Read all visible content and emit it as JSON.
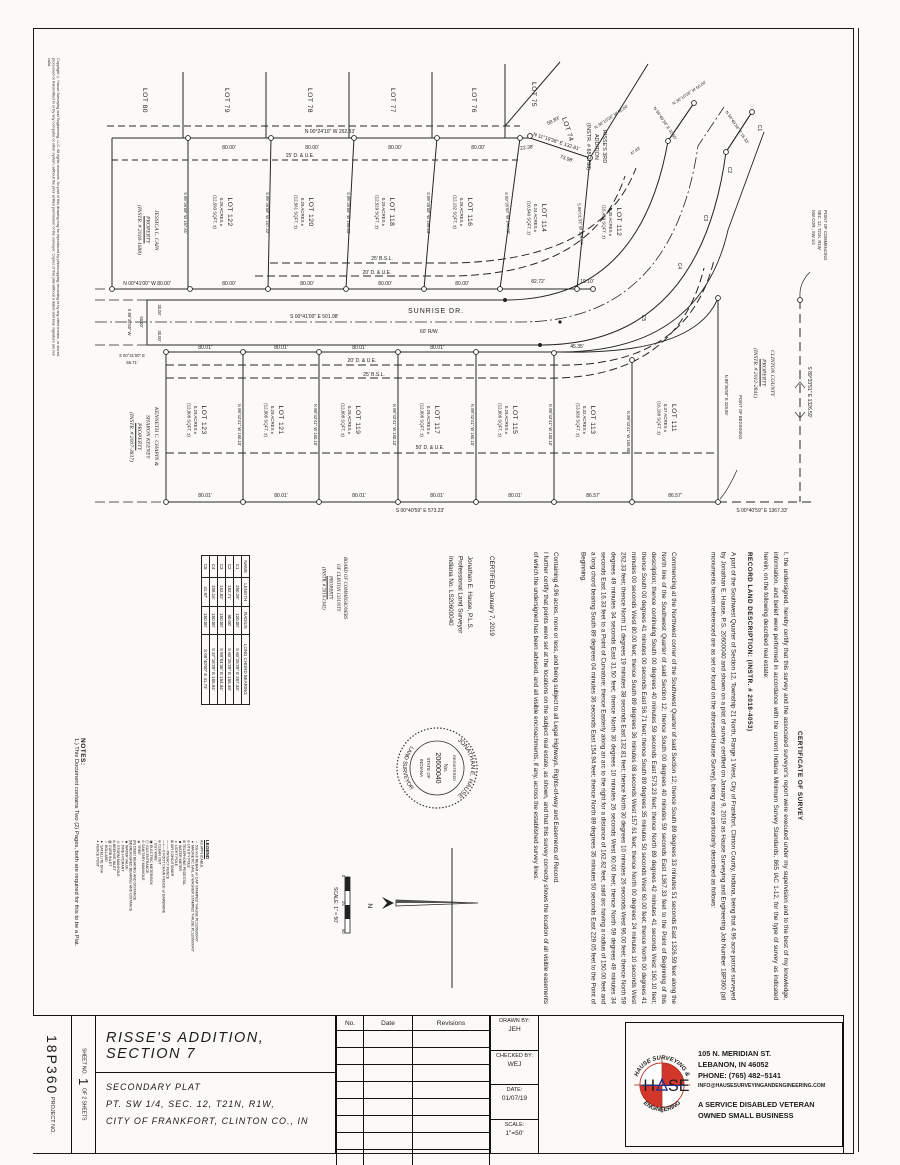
{
  "doc": {
    "type_note": "Secondary plat survey drawing"
  },
  "copyright": "Copyright © Hause Surveying and Engineering, LLC. All rights reserved. No part of this drawing may be reproduced by photocopying, recording or by any other means, or stored, processed or transmitted in or by any computer or other system, without the prior written permission of the surveyor. Copies of this plat without a dated and blue signature are not valid.",
  "plat": {
    "neighbors": [
      "LOT 80",
      "LOT 79",
      "LOT 78",
      "LOT 77",
      "LOT 76",
      "LOT 75"
    ],
    "lot74": {
      "name": "LOT 74",
      "lines": [
        "RISSE'S 3RD",
        "ADDITION",
        "(INSTR. # 68-2788)"
      ]
    },
    "upper_lots": [
      {
        "name": "LOT 122",
        "acres": "0.28 ACRES ±",
        "sqft": "(12,593 SQFT. ±)",
        "side": "S 89°36'08\" W  157.61'"
      },
      {
        "name": "LOT 120",
        "acres": "0.29 ACRES ±",
        "sqft": "(12,561 SQFT. ±)",
        "side": "S 89°36'08\" W  157.22'"
      },
      {
        "name": "LOT 118",
        "acres": "0.29 ACRES ±",
        "sqft": "(12,529 SQFT. ±)",
        "side": "S 89°36'08\" W  156.83'"
      },
      {
        "name": "LOT 116",
        "acres": "0.28 ACRES ±",
        "sqft": "(12,132 SQFT. ±)",
        "side": "S 89°36'08\" W  156.43'"
      },
      {
        "name": "LOT 114",
        "acres": "0.24 ACRES ±",
        "sqft": "(10,540 SQFT. ±)",
        "side": "S 89°35'50\" W  144.08'"
      },
      {
        "name": "LOT 112",
        "acres": "0.35 ACRES ±",
        "sqft": "(15,459 SQFT. ±)",
        "side": "S 89°01'33\" W  129.04'"
      }
    ],
    "lower_lots": [
      {
        "name": "LOT 123",
        "acres": "0.29 ACRES ±",
        "sqft": "(12,808 SQFT. ±)",
        "side": "N 89°42'41\" W  160.10'"
      },
      {
        "name": "LOT 121",
        "acres": "0.29 ACRES ±",
        "sqft": "(12,808 SQFT. ±)",
        "side": "N 89°42'41\" W  160.10'"
      },
      {
        "name": "LOT 119",
        "acres": "0.29 ACRES ±",
        "sqft": "(12,808 SQFT. ±)",
        "side": "N 89°42'41\" W  160.10'"
      },
      {
        "name": "LOT 117",
        "acres": "0.29 ACRES ±",
        "sqft": "(12,808 SQFT. ±)",
        "side": "N 89°42'41\" W  160.10'"
      },
      {
        "name": "LOT 115",
        "acres": "0.29 ACRES ±",
        "sqft": "(12,808 SQFT. ±)",
        "side": "N 89°42'41\" W  160.10'"
      },
      {
        "name": "LOT 113",
        "acres": "0.32 ACRES ±",
        "sqft": "(13,936 SQFT. ±)",
        "side": "N 89°42'41\" W  165.90'"
      },
      {
        "name": "LOT 111",
        "acres": "0.37 ACRES ±",
        "sqft": "(16,188 SQFT. ±)",
        "side": "N 89°35'50\" E  229.05'"
      }
    ],
    "street": {
      "name": "SUNRISE DR.",
      "rw": "60'  R/W",
      "bearing": "S 00°41'00\" E   501.98'"
    },
    "dims": {
      "top_bearing": "N 00°24'10\" W   262.33'",
      "seg80": "80.00'",
      "seg2238": "22.38'",
      "seg5883": "58.83'",
      "diag_bearing": "N 11°19'38\" E   132.81'",
      "seg7398": "73.98'",
      "seg8272": "82.72'",
      "seg1910": "19.10'",
      "west80": "N 00°41'00\" W   80.00'",
      "seg8001": "80.01'",
      "seg4535": "45.35'",
      "seg8657": "86.57'",
      "bottom_bearing": "S 00°40'59\" E   573.23'",
      "east_bearing": "S 00°40'59\" E   1367.33'",
      "north_line": "S 89°33'51\" E   1326.59'",
      "jog_30": "30.00'",
      "jog_60": "60.00'",
      "jog_brg": "S 89°35'50\" W",
      "jog_e": "S 00°41'00\" E",
      "jog_5671": "56.71'",
      "stub": [
        "N 30°10'26\" W  96.00'",
        "N 59°49'34\" E  31.50'",
        "N 30°10'26\" W  60.00'",
        "N 59°49'34\" E  16.33'",
        "47.83'"
      ]
    },
    "easements_upper": [
      "15' D. & U.E.",
      "25' B.S.L.",
      "20' D. & U.E."
    ],
    "easements_lower": [
      "20' D. & U.E.",
      "25' B.S.L.",
      "50' D. & U.E."
    ],
    "curve_labels": [
      "C1",
      "C2",
      "C3",
      "C4",
      "C5"
    ],
    "poc_label": [
      "NW COR., SW 1/4",
      "SEC. 12, T21N, R1W",
      "POINT OF COMMENCING"
    ],
    "pob_label": "POINT OF BEGINNING",
    "owners": {
      "jessica": [
        "JESSICA L. CAIN",
        "PROPERTY",
        "(INSTR. # 2018-1688)"
      ],
      "kenneth": [
        "KENNETH C. CHAPIN &",
        "SHARON KEENEY",
        "PROPERTY",
        "(INSTR. # 2007-3837)"
      ],
      "clinton": [
        "CLINTON COUNTY",
        "PROPERTY",
        "(INSTR. # 2012-2841)"
      ],
      "board": [
        "BOARD OF COMMISSIONERS",
        "OF CLINTON COUNTY",
        "PROPERTY",
        "(INSTR. # 2010-1342)"
      ]
    },
    "curve_table": {
      "headers": [
        "NAME",
        "LENGTH",
        "RADIUS",
        "LONG CHORD BEARING"
      ],
      "rows": [
        [
          "C1",
          "250.28'",
          "120.00'",
          "S 60°25'28\" E   207.33'"
        ],
        [
          "C2",
          "182.71'",
          "90.00'",
          "S 60°25'28\" E   155.49'"
        ],
        [
          "C3",
          "162.82'",
          "150.00'",
          "S 89°04'36\" E   154.94'"
        ],
        [
          "C4",
          "108.16'",
          "150.00'",
          "S 37°18'28\" E   105.84'"
        ],
        [
          "C5",
          "41.97'",
          "150.00'",
          "S 08°40'00\" E   41.73'"
        ]
      ]
    },
    "legend": {
      "title": "LEGEND",
      "subtitle": "AS APPLICABLE",
      "items": [
        {
          "sym": "○",
          "label": "5/8-inch REBAR w/ CAP STAMPED \"HAUSE PLS20600040\""
        },
        {
          "sym": "●",
          "label": "MAGNETIC NAIL w/ WASHER STAMPED \"HAUSE PLS20600040\""
        },
        {
          "sym": "⊘",
          "label": "UTILITY POLE"
        },
        {
          "sym": "⊞",
          "label": "TELEPHONE PEDESTAL"
        },
        {
          "sym": "◙",
          "label": "WATER METER"
        },
        {
          "sym": "✶",
          "label": "LIGHT POLE"
        },
        {
          "sym": "⊠",
          "label": "AIR CONDITIONER"
        },
        {
          "sym": "—··—",
          "label": "PRIVACY FENCE"
        },
        {
          "sym": "—+—",
          "label": "6 FOOT CHAIN FENCE w/ BARBWIRE"
        },
        {
          "sym": "⊕",
          "label": "CLEAN OUT"
        },
        {
          "sym": "↓",
          "label": "GUY WIRE"
        },
        {
          "sym": "▣",
          "label": "ELECTRIC METER/BOX"
        },
        {
          "sym": "◫",
          "label": "GAS ENTRANCE"
        },
        {
          "sym": "⊙",
          "label": "SANITARY MANHOLE"
        },
        {
          "sym": "❀",
          "label": "TREE"
        },
        {
          "sym": "(R)",
          "label": "DEED BEARING AND DISTANCE"
        },
        {
          "sym": "(M)",
          "label": "MEASURED BEARING AND DISTANCE"
        },
        {
          "sym": "■",
          "label": "WATER VALVE"
        },
        {
          "sym": "♆",
          "label": "FIRE HYDRANT"
        },
        {
          "sym": "◎",
          "label": "STORM MANHOLE"
        },
        {
          "sym": "⊛",
          "label": "BEEHIVE INLET"
        },
        {
          "sym": "▤",
          "label": "CURB INLET"
        },
        {
          "sym": "○",
          "label": "BOLLARD"
        },
        {
          "sym": "▼",
          "label": "SATELLITE DISH"
        },
        {
          "sym": "⁕",
          "label": "FENCE POST"
        }
      ]
    },
    "notes": {
      "title": "NOTES:",
      "items": [
        "1.) This Document contains Two (2) Pages, both are required for this to be a Plat."
      ]
    },
    "scalebar": {
      "label": "SCALE: 1\" = 50'",
      "ticks": [
        "0",
        "25",
        "50"
      ],
      "north": "N"
    }
  },
  "cert": {
    "title": "CERTIFICATE OF SURVEY",
    "p1": "I, the undersigned, hereby certify that this survey and the associated surveyor's report were executed under my supervision and to the best of my knowledge, information, and belief were performed in accordance with the current Indiana Minimum Survey Standards, 865 IAC 1-12, for the type of survey as indicated herein, on the following described real estate:",
    "record_title": "RECORD LAND DESCRIPTION: (INSTR. # 2018-4053)",
    "p2": "A part of the Southwest Quarter of Section 12, Township 21 North, Range 1 West, City of Frankfort, Clinton County, Indiana, being that 4.96 acre parcel surveyed by Jonathan E. Hause, P.S. 20600040 and shown on a plat of survey certified on January 9, 2019 as Hause Surveying and Engineering Job Number 18P360 (all monuments herein referenced are as set or found on the aforesaid Hause Survey), being more particularly described as follows:",
    "metes": "Commencing at the Northwest corner of the Southwest Quarter of said Section 12; thence South 89 degrees 33 minutes 51 seconds East 1326.59 feet along the North line of the Southwest Quarter of said Section 12; thence South 00 degrees 40 minutes 59 seconds East 1367.33 feet to the Point of Beginning of this description; thence continuing South 00 degrees 40 minutes 59 seconds East 573.23 feet; thence North 89 degrees 42 minutes 41 seconds West 160.10 feet; thence South 00 degrees 41 minutes 00 seconds East 56.71 feet; thence South 89 degrees 35 minutes 50 seconds West 60.00 feet; thence North 00 degrees 41 minutes 00 seconds West 80.00 feet; thence South 89 degrees 36 minutes 08 seconds West 157.61 feet; thence North 00 degrees 24 minutes 10 seconds West 262.33 feet; thence North 11 degrees 19 minutes 38 seconds East 132.81 feet; thence North 30 degrees 10 minutes 26 seconds West 96.00 feet; thence North 59 degrees 49 minutes 34 seconds East 31.50 feet; thence North 30 degrees 10 minutes 26 seconds West 60.00 feet; thence North 59 degrees 49 minutes 34 seconds East 16.33 feet to a Point of Curvature; thence Easterly along an arc to the right for a distance of 162.82 feet, said arc having a radius of 150.00 feet and a long chord bearing South 89 degrees 04 minutes 36 seconds East 154.94 feet; thence North 89 degrees 35 minutes 50 seconds East 229.05 feet to the Point of Beginning.",
    "containing": "Containing 4.96 acres, more or less, and being subject to all Legal Highways, Rights-of-way and Easements of Record.",
    "further": "I further certify that points were set at the locations on the subject real estate, as shown, and that this survey correctly shows the location of all visible easements of which the undersigned has been advised, and all visible encroachments, if any, across the established survey lines.",
    "certified": "CERTIFIED January 7, 2019",
    "surveyor": [
      "Jonathan E. Hause, P.L.S.",
      "Professional Land Surveyor",
      "Indiana No. LS20600040"
    ],
    "seal": {
      "arc_top": "JONATHAN E. HAUSE",
      "registered": "REGISTERED",
      "no_label": "No.",
      "number": "20600040",
      "state": "STATE OF",
      "state2": "INDIANA",
      "arc_bottom": "LAND SURVEYOR"
    }
  },
  "titleblock": {
    "project_label": "PROJECT NO.",
    "project_no": "18P360",
    "sheet_label": "SHEET NO.",
    "sheet_no": "1",
    "sheet_of": "OF 2 SHEETS",
    "title": "RISSE'S ADDITION, SECTION 7",
    "sub1": "SECONDARY PLAT",
    "sub2": "PT. SW 1/4, SEC. 12, T21N, R1W,",
    "sub3": "CITY OF FRANKFORT, CLINTON CO., IN",
    "rev_headers": [
      "No.",
      "Date",
      "Revisions"
    ],
    "drawn_label": "DRAWN BY:",
    "drawn": "JEH",
    "checked_label": "CHECKED BY:",
    "checked": "WEJ",
    "date_label": "DATE:",
    "date": "01/07/19",
    "scale_label": "SCALE:",
    "scale": "1\"=50'"
  },
  "company": {
    "addr1": "105 N. MERIDIAN ST.",
    "addr2": "LEBANON, IN   46052",
    "phone": "PHONE: (765) 482–5141",
    "email": "INFO@HAUSESURVEYINGANDENGINEERING.COM",
    "vet1": "A SERVICE DISABLED VETERAN",
    "vet2": "OWNED SMALL BUSINESS",
    "logo_top": "HAUSE SURVEYING &",
    "logo_bottom": "ENGINEERING",
    "logo_h": "H",
    "logo_se": "SE",
    "colors": {
      "red": "#d3362a",
      "blue": "#23308c"
    }
  }
}
